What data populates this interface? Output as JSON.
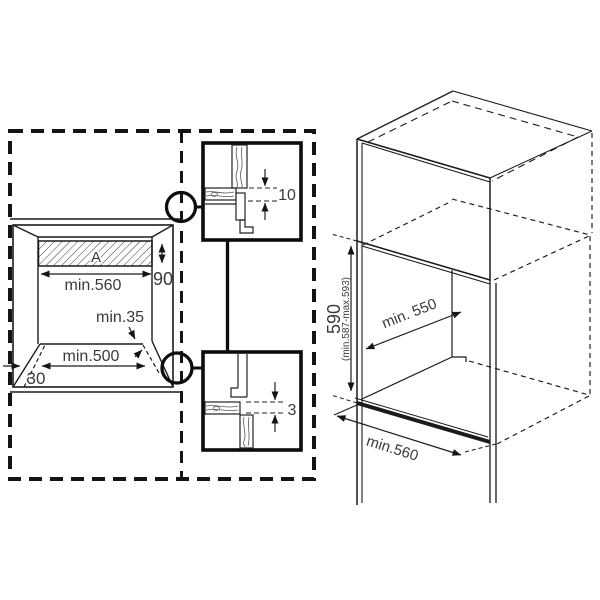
{
  "front_view": {
    "panel_label": "A",
    "dim_strip_height": "90",
    "dim_width": "min.560",
    "dim_recess": "min.35",
    "dim_floor_width": "min.500",
    "dim_side_clearance": "30"
  },
  "detail_top": {
    "dim_gap": "10"
  },
  "detail_bottom": {
    "dim_gap": "3"
  },
  "isometric_view": {
    "dim_height": "590",
    "dim_height_range": "(min.587-max.593)",
    "dim_depth": "min. 550",
    "dim_width": "min.560"
  },
  "colors": {
    "line": "#1b1b1b",
    "heavy": "#0d0d0d",
    "text": "#3a3a3a"
  }
}
